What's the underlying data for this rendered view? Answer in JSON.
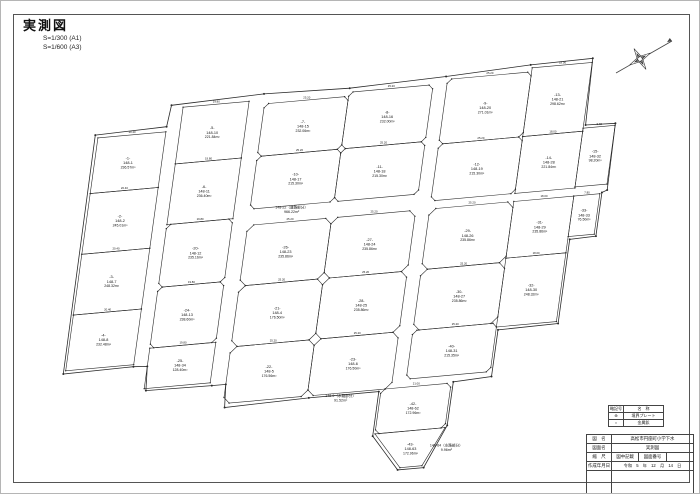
{
  "page": {
    "title": "実測図",
    "scale_a1": "S=1/300 (A1)",
    "scale_a3": "S=1/600 (A3)"
  },
  "legend": {
    "header_symbol": "略記号",
    "header_name": "名　称",
    "rows": [
      {
        "symbol": "⊕",
        "name": "境界プレート"
      },
      {
        "symbol": "○",
        "name": "金属鋲"
      }
    ]
  },
  "title_block": {
    "r1_label": "図　名",
    "r1_value": "高松市円座町小学下水",
    "r2_label": "図面名",
    "r2_value": "実測図",
    "r3_label": "縮　尺",
    "r3_value": "図中記載",
    "r3_label2": "図面番号",
    "r3_value2": "",
    "r4_label": "作成年月日",
    "r4_value": "令和　5　年　12　月　14　日"
  },
  "map": {
    "line_color": "#2a2a2a",
    "dim_scale_m_per_px": 0.3,
    "parcels": [
      {
        "rect": [
          78,
          115,
          68,
          55
        ],
        "ch": 0,
        "labels": [
          "-1-",
          "148-1",
          "236.57m²"
        ]
      },
      {
        "rect": [
          78,
          170,
          68,
          60
        ],
        "ch": 0,
        "labels": [
          "-2-",
          "148-2",
          "245.01m²"
        ]
      },
      {
        "rect": [
          78,
          230,
          68,
          60
        ],
        "ch": 0,
        "labels": [
          "-3-",
          "148-7",
          "248.32m²"
        ]
      },
      {
        "rect": [
          78,
          290,
          68,
          55
        ],
        "ch": 0,
        "labels": [
          "-4-",
          "148-8",
          "232.48m²"
        ]
      },
      {
        "rect": [
          160,
          92,
          66,
          56
        ],
        "ch": 0,
        "labels": [
          "-5-",
          "148-10",
          "221.84m²"
        ]
      },
      {
        "rect": [
          160,
          148,
          66,
          60
        ],
        "ch": 0,
        "labels": [
          "-6-",
          "148-11",
          "236.40m²"
        ]
      },
      {
        "rect": [
          160,
          208,
          66,
          62
        ],
        "ch": 4,
        "labels": [
          "-20-",
          "148-12",
          "235.16m²"
        ]
      },
      {
        "rect": [
          160,
          270,
          66,
          60
        ],
        "ch": 4,
        "labels": [
          "-24-",
          "148-13",
          "238.60m²"
        ]
      },
      {
        "rect": [
          160,
          330,
          66,
          40
        ],
        "ch": 0,
        "labels": [
          "-25-",
          "148-34",
          "128.40m²"
        ]
      },
      {
        "rect": [
          242,
          96,
          84,
          52
        ],
        "ch": 4,
        "labels": [
          "-7-",
          "148-15",
          "232.06m²"
        ]
      },
      {
        "rect": [
          242,
          148,
          84,
          52
        ],
        "ch": 4,
        "labels": [
          "-10-",
          "148-17",
          "215.30m²"
        ]
      },
      {
        "rect": [
          242,
          216,
          84,
          60
        ],
        "ch": 6,
        "labels": [
          "-26-",
          "148-23",
          "235.86m²"
        ]
      },
      {
        "rect": [
          242,
          276,
          84,
          60
        ],
        "ch": 6,
        "labels": [
          "-21-",
          "148-4",
          "176.50m²"
        ]
      },
      {
        "rect": [
          242,
          336,
          84,
          56
        ],
        "ch": 6,
        "labels": [
          "-22-",
          "148-5",
          "176.56m²"
        ]
      },
      {
        "rect": [
          326,
          92,
          84,
          56
        ],
        "ch": 4,
        "labels": [
          "-8-",
          "148-16",
          "232.00m²"
        ]
      },
      {
        "rect": [
          326,
          148,
          84,
          52
        ],
        "ch": 4,
        "labels": [
          "-11-",
          "148-18",
          "215.30m²"
        ]
      },
      {
        "rect": [
          326,
          216,
          84,
          60
        ],
        "ch": 6,
        "labels": [
          "-27-",
          "148-24",
          "235.86m²"
        ]
      },
      {
        "rect": [
          326,
          276,
          84,
          60
        ],
        "ch": 6,
        "labels": [
          "-28-",
          "148-25",
          "235.86m²"
        ]
      },
      {
        "rect": [
          326,
          336,
          84,
          56
        ],
        "ch": 6,
        "labels": [
          "-23-",
          "148-6",
          "176.50m²"
        ]
      },
      {
        "rect": [
          400,
          392,
          70,
          44
        ],
        "ch": 4,
        "labels": [
          "-42-",
          "148-62",
          "172.96m²"
        ]
      },
      {
        "pts": [
          [
            400,
            436
          ],
          [
            470,
            436
          ],
          [
            452,
            472
          ],
          [
            430,
            472
          ]
        ],
        "labels": [
          "-43-",
          "148-63",
          "172.96m²"
        ]
      },
      {
        "rect": [
          424,
          88,
          84,
          64
        ],
        "ch": 4,
        "labels": [
          "-9-",
          "148-20",
          "271.01m²"
        ]
      },
      {
        "rect": [
          424,
          152,
          84,
          56
        ],
        "ch": 4,
        "labels": [
          "-12-",
          "148-19",
          "215.30m²"
        ]
      },
      {
        "rect": [
          424,
          216,
          84,
          60
        ],
        "ch": 6,
        "labels": [
          "-29-",
          "148-26",
          "235.86m²"
        ]
      },
      {
        "rect": [
          424,
          276,
          84,
          60
        ],
        "ch": 6,
        "labels": [
          "-30-",
          "148-27",
          "235.86m²"
        ]
      },
      {
        "rect": [
          424,
          336,
          84,
          48
        ],
        "ch": 4,
        "labels": [
          "-40-",
          "148-31",
          "215.35m²"
        ]
      },
      {
        "rect": [
          508,
          84,
          60,
          68
        ],
        "ch": 0,
        "labels": [
          "-13-",
          "148-21",
          "298.62m²"
        ]
      },
      {
        "rect": [
          508,
          152,
          60,
          56
        ],
        "ch": 0,
        "labels": [
          "-14-",
          "148-28",
          "221.84m²"
        ]
      },
      {
        "rect": [
          508,
          216,
          60,
          56
        ],
        "ch": 0,
        "labels": [
          "-31-",
          "148-29",
          "235.86m²"
        ]
      },
      {
        "rect": [
          508,
          272,
          60,
          68
        ],
        "ch": 0,
        "labels": [
          "-32-",
          "148-30",
          "248.32m²"
        ]
      },
      {
        "rect": [
          568,
          149,
          32,
          58
        ],
        "ch": 0,
        "labels": [
          "-15-",
          "148-32",
          "98.20m²"
        ]
      },
      {
        "rect": [
          568,
          216,
          26,
          40
        ],
        "ch": 0,
        "labels": [
          "-33-",
          "148-33",
          "76.50m²"
        ]
      }
    ],
    "floating_labels": [
      {
        "x": 284,
        "y": 203,
        "lines": [
          "148-22（道路部分）",
          "966.22m²"
        ]
      },
      {
        "x": 360,
        "y": 396,
        "lines": [
          "148-9（水路部分）",
          "91.52m²"
        ]
      },
      {
        "x": 474,
        "y": 455,
        "lines": [
          "148-64（水路部分）",
          "9.96m²"
        ]
      }
    ],
    "boundary": [
      [
        75,
        112
      ],
      [
        146,
        110
      ],
      [
        148,
        89
      ],
      [
        240,
        86
      ],
      [
        326,
        88
      ],
      [
        422,
        85
      ],
      [
        506,
        81
      ],
      [
        568,
        80
      ],
      [
        570,
        146
      ],
      [
        600,
        147
      ],
      [
        601,
        213
      ],
      [
        596,
        215
      ],
      [
        596,
        258
      ],
      [
        570,
        259
      ],
      [
        570,
        342
      ],
      [
        510,
        343
      ],
      [
        510,
        389
      ],
      [
        472,
        391
      ],
      [
        472,
        434
      ],
      [
        454,
        474
      ],
      [
        428,
        474
      ],
      [
        398,
        438
      ],
      [
        398,
        394
      ],
      [
        328,
        394
      ],
      [
        244,
        396
      ],
      [
        242,
        373
      ],
      [
        228,
        373
      ],
      [
        162,
        372
      ],
      [
        160,
        348
      ],
      [
        146,
        347
      ],
      [
        76,
        348
      ]
    ]
  }
}
